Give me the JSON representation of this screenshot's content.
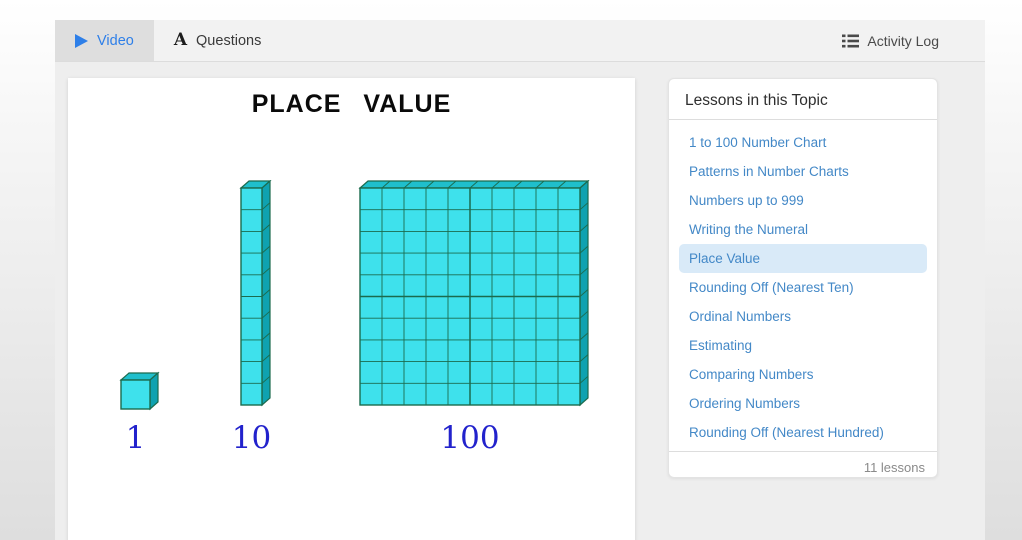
{
  "tabs": {
    "video_label": "Video",
    "questions_label": "Questions",
    "activity_log_label": "Activity Log"
  },
  "video": {
    "title": "PLACE VALUE",
    "blocks": [
      {
        "label": "1",
        "value": 1,
        "rows": 1,
        "cols": 1
      },
      {
        "label": "10",
        "value": 10,
        "rows": 10,
        "cols": 1
      },
      {
        "label": "100",
        "value": 100,
        "rows": 10,
        "cols": 10
      }
    ],
    "colors": {
      "front": "#3EE1EC",
      "top": "#1FBFCC",
      "side": "#0FA2B0",
      "outline": "#1B6B4E",
      "label": "#2222CC"
    }
  },
  "lessons": {
    "title": "Lessons in this Topic",
    "items": [
      "1 to 100 Number Chart",
      "Patterns in Number Charts",
      "Numbers up to 999",
      "Writing the Numeral",
      "Place Value",
      "Rounding Off (Nearest Ten)",
      "Ordinal Numbers",
      "Estimating",
      "Comparing Numbers",
      "Ordering Numbers",
      "Rounding Off (Nearest Hundred)"
    ],
    "active_index": 4,
    "count_label": "11 lessons"
  }
}
